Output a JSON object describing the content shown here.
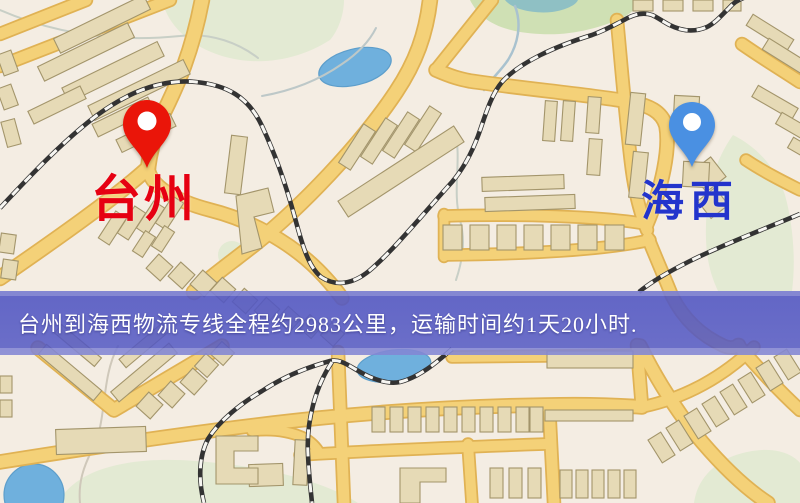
{
  "map": {
    "origin_marker": {
      "label": "台州",
      "pin_color": "#ea1509",
      "label_color": "#e60012"
    },
    "destination_marker": {
      "label": "海西",
      "pin_color": "#4a90e2",
      "label_color": "#2334cc"
    },
    "banner": {
      "text": "台州到海西物流专线全程约2983公里，运输时间约1天20小时.",
      "bg_color": "#5257c3",
      "text_color": "#ffffff"
    },
    "palette": {
      "background": "#f4ede3",
      "road": "#f4d178",
      "road_casing": "#e0b254",
      "park": "#cfe0b4",
      "park_pale": "#e3ead3",
      "water": "#6fb0dd",
      "building": "#e6dab6",
      "building_stroke": "#a3956b",
      "railway": "#333333"
    }
  }
}
